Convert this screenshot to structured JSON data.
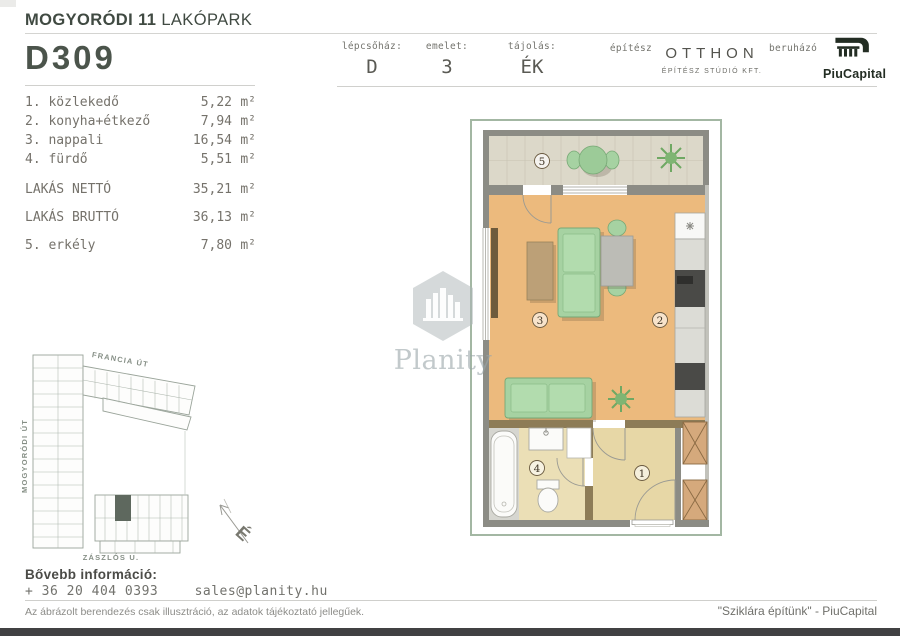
{
  "header": {
    "project_title_bold": "MOGYORÓDI 11",
    "project_title_rest": " LAKÓPARK",
    "unit_code": "D309",
    "fields": [
      {
        "label": "lépcsőház:",
        "value": "D"
      },
      {
        "label": "emelet:",
        "value": "3"
      },
      {
        "label": "tájolás:",
        "value": "ÉK"
      }
    ],
    "architect_label": "építész",
    "architect_name": "OTTHON",
    "architect_subtitle": "ÉPÍTÉSZ STÚDIÓ KFT.",
    "developer_label": "beruházó",
    "developer_name": "PiuCapital"
  },
  "room_list": {
    "rooms": [
      {
        "name": "1. közlekedő",
        "area": "5,22",
        "unit": "m²"
      },
      {
        "name": "2. konyha+étkező",
        "area": "7,94",
        "unit": "m²"
      },
      {
        "name": "3. nappali",
        "area": "16,54",
        "unit": "m²"
      },
      {
        "name": "4. fürdő",
        "area": "5,51",
        "unit": "m²"
      }
    ],
    "net_label": "LAKÁS NETTÓ",
    "net_area": "35,21",
    "net_unit": "m²",
    "gross_label": "LAKÁS BRUTTÓ",
    "gross_area": "36,13",
    "gross_unit": "m²",
    "balcony_label": "5. erkély",
    "balcony_area": "7,80",
    "balcony_unit": "m²"
  },
  "floor_plan": {
    "labels": {
      "hallway": "1",
      "kitchen": "2",
      "living": "3",
      "bathroom": "4",
      "balcony": "5"
    }
  },
  "site_map": {
    "street_top": "FRANCIA ÚT",
    "street_left": "MOGYORÓDI ÚT",
    "street_bottom": "ZÁSZLÓS U.",
    "north": "É"
  },
  "watermark": {
    "text": "Planity"
  },
  "footer": {
    "info_label": "Bővebb információ:",
    "phone": "+ 36 20 404 0393",
    "email": "sales@planity.hu",
    "disclaimer": "Az ábrázolt berendezés csak illusztráció, az adatok tájékoztató jellegűek.",
    "slogan": "\"Sziklára építünk\" - PiuCapital"
  },
  "colors": {
    "accent_green": "#a3b7a3",
    "wood_floor": "#ecba7d",
    "wall_gray": "#8c8c85",
    "wall_olive": "#8d7c57",
    "furniture_green": "#a6d2a2",
    "logo_dark": "#232d23"
  }
}
